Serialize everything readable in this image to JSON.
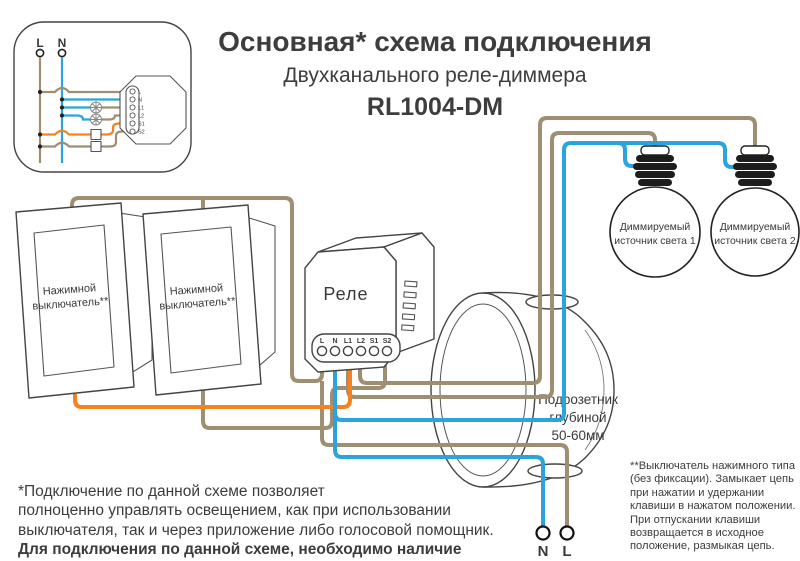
{
  "title": {
    "line1": "Основная* схема подключения",
    "line2": "Двухканального реле-диммера",
    "line3": "RL1004-DM"
  },
  "inset": {
    "l_label": "L",
    "n_label": "N"
  },
  "relay": {
    "label": "Реле",
    "terminals": [
      "L",
      "N",
      "L1",
      "L2",
      "S1",
      "S2"
    ]
  },
  "switches": {
    "switch1_line1": "Нажимной",
    "switch1_line2": "выключатель**",
    "switch2_line1": "Нажимной",
    "switch2_line2": "выключатель**"
  },
  "bulbs": {
    "bulb1_line1": "Диммируемый",
    "bulb1_line2": "источник света 1",
    "bulb2_line1": "Диммируемый",
    "bulb2_line2": "источник света 2"
  },
  "junction_box": {
    "line1": "Подрозетник",
    "line2": "глубиной",
    "line3": "50-60мм"
  },
  "supply": {
    "n_label": "N",
    "l_label": "L"
  },
  "footnote_left": {
    "normal": "*Подключение по данной схеме позволяет\nполноценно управлять освещением, как при использовании\nвыключателя, так и через приложение либо голосовой помощник.",
    "bold": "Для подключения по данной схеме, необходимо наличие\nнулевого провода в подрозетнике или распаечной коробке."
  },
  "footnote_right": {
    "text": "**Выключатель нажимного типа\n(без фиксации). Замыкает цепь\nпри нажатии и удержании\nклавиши в нажатом положении.\nПри отпускании клавиши\nвозвращается в исходное\nположение, размыкая цепь."
  },
  "colors": {
    "wire_line": "#9e8e72",
    "wire_switch": "#f58220",
    "wire_neutral": "#2ba3dc",
    "outline": "#3a3a3a"
  }
}
